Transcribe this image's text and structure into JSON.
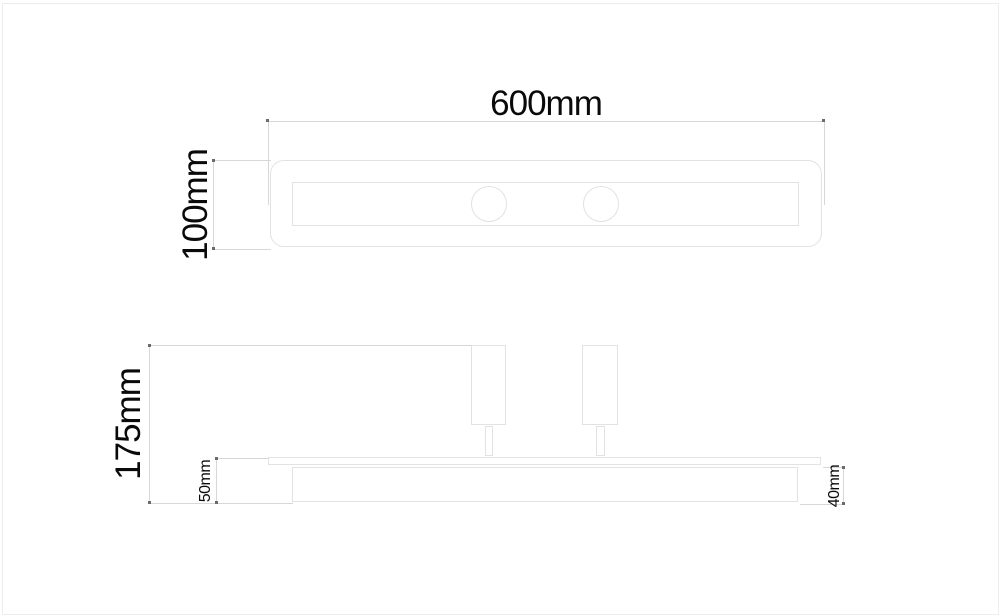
{
  "drawing": {
    "kind": "technical dimension drawing of a two-spot linear ceiling light",
    "unit": "mm",
    "views": {
      "top_view": {
        "name": "top view",
        "spot_count": 2
      },
      "side_view": {
        "name": "side view",
        "spot_count": 2
      }
    }
  },
  "dims": {
    "width_top": {
      "label": "600mm",
      "value_mm": 600
    },
    "depth_top": {
      "label": "100mm",
      "value_mm": 100
    },
    "height_total": {
      "label": "175mm",
      "value_mm": 175
    },
    "height_left": {
      "label": "50mm",
      "value_mm": 50
    },
    "height_body": {
      "label": "40mm",
      "value_mm": 40
    }
  }
}
